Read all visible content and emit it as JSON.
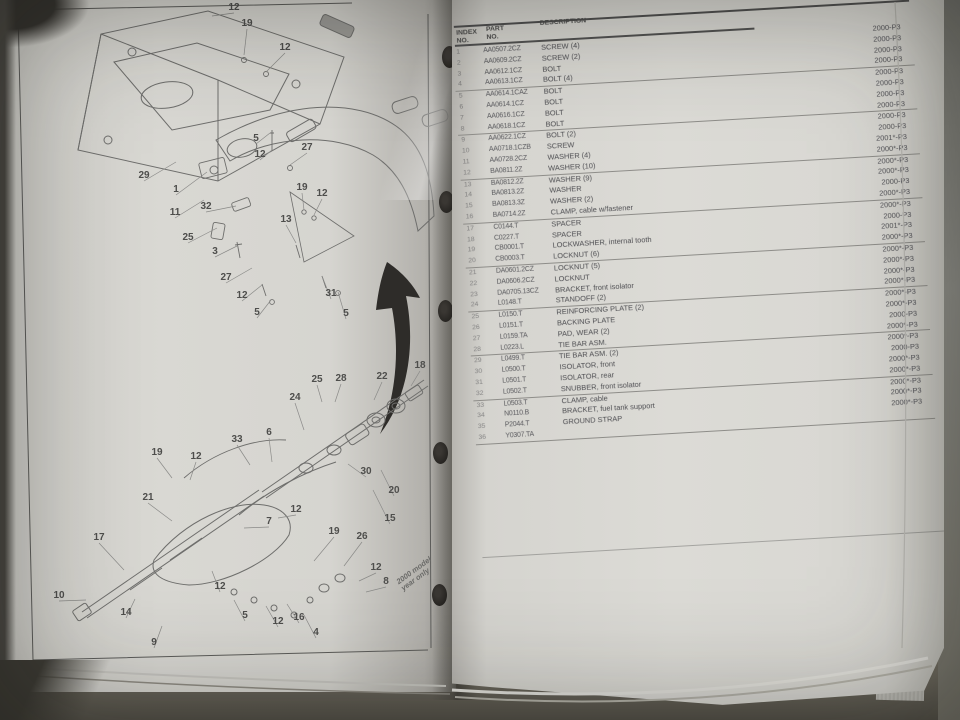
{
  "left_page": {
    "note_rotated": "2000 model\nyear only",
    "callouts": [
      {
        "n": "12",
        "x": 230,
        "y": 10,
        "lx": 208,
        "ly": 16
      },
      {
        "n": "19",
        "x": 243,
        "y": 26,
        "lx": 240,
        "ly": 55
      },
      {
        "n": "12",
        "x": 281,
        "y": 50,
        "lx": 262,
        "ly": 72
      },
      {
        "n": "5",
        "x": 252,
        "y": 141,
        "lx": 266,
        "ly": 133
      },
      {
        "n": "12",
        "x": 256,
        "y": 157,
        "lx": 268,
        "ly": 150
      },
      {
        "n": "27",
        "x": 303,
        "y": 150,
        "lx": 286,
        "ly": 165
      },
      {
        "n": "29",
        "x": 140,
        "y": 178,
        "lx": 172,
        "ly": 162
      },
      {
        "n": "1",
        "x": 172,
        "y": 192,
        "lx": 203,
        "ly": 172
      },
      {
        "n": "11",
        "x": 171,
        "y": 215,
        "lx": 200,
        "ly": 200
      },
      {
        "n": "32",
        "x": 202,
        "y": 209,
        "lx": 232,
        "ly": 206
      },
      {
        "n": "25",
        "x": 184,
        "y": 240,
        "lx": 213,
        "ly": 228
      },
      {
        "n": "3",
        "x": 211,
        "y": 254,
        "lx": 233,
        "ly": 246
      },
      {
        "n": "19",
        "x": 298,
        "y": 190,
        "lx": 300,
        "ly": 210
      },
      {
        "n": "12",
        "x": 318,
        "y": 196,
        "lx": 310,
        "ly": 215
      },
      {
        "n": "13",
        "x": 282,
        "y": 222,
        "lx": 292,
        "ly": 243
      },
      {
        "n": "27",
        "x": 222,
        "y": 280,
        "lx": 248,
        "ly": 268
      },
      {
        "n": "12",
        "x": 238,
        "y": 298,
        "lx": 258,
        "ly": 285
      },
      {
        "n": "5",
        "x": 253,
        "y": 315,
        "lx": 267,
        "ly": 300
      },
      {
        "n": "31",
        "x": 327,
        "y": 296,
        "lx": 318,
        "ly": 276
      },
      {
        "n": "5",
        "x": 342,
        "y": 316,
        "lx": 334,
        "ly": 292
      },
      {
        "n": "25",
        "x": 313,
        "y": 382,
        "lx": 318,
        "ly": 402
      },
      {
        "n": "28",
        "x": 337,
        "y": 381,
        "lx": 331,
        "ly": 402
      },
      {
        "n": "22",
        "x": 378,
        "y": 379,
        "lx": 370,
        "ly": 400
      },
      {
        "n": "18",
        "x": 416,
        "y": 368,
        "lx": 407,
        "ly": 386
      },
      {
        "n": "24",
        "x": 291,
        "y": 400,
        "lx": 300,
        "ly": 430
      },
      {
        "n": "33",
        "x": 233,
        "y": 442,
        "lx": 246,
        "ly": 465
      },
      {
        "n": "6",
        "x": 265,
        "y": 435,
        "lx": 268,
        "ly": 462
      },
      {
        "n": "19",
        "x": 153,
        "y": 455,
        "lx": 168,
        "ly": 478
      },
      {
        "n": "12",
        "x": 192,
        "y": 459,
        "lx": 186,
        "ly": 480
      },
      {
        "n": "30",
        "x": 362,
        "y": 474,
        "lx": 344,
        "ly": 464
      },
      {
        "n": "20",
        "x": 390,
        "y": 493,
        "lx": 377,
        "ly": 470
      },
      {
        "n": "15",
        "x": 386,
        "y": 521,
        "lx": 369,
        "ly": 490
      },
      {
        "n": "21",
        "x": 144,
        "y": 500,
        "lx": 168,
        "ly": 521
      },
      {
        "n": "12",
        "x": 292,
        "y": 512,
        "lx": 274,
        "ly": 518
      },
      {
        "n": "7",
        "x": 265,
        "y": 524,
        "lx": 240,
        "ly": 528
      },
      {
        "n": "17",
        "x": 95,
        "y": 540,
        "lx": 120,
        "ly": 570
      },
      {
        "n": "19",
        "x": 330,
        "y": 534,
        "lx": 310,
        "ly": 561
      },
      {
        "n": "26",
        "x": 358,
        "y": 539,
        "lx": 340,
        "ly": 566
      },
      {
        "n": "12",
        "x": 372,
        "y": 570,
        "lx": 355,
        "ly": 581
      },
      {
        "n": "8",
        "x": 382,
        "y": 584,
        "lx": 362,
        "ly": 592
      },
      {
        "n": "12",
        "x": 216,
        "y": 589,
        "lx": 208,
        "ly": 571
      },
      {
        "n": "5",
        "x": 241,
        "y": 618,
        "lx": 230,
        "ly": 600
      },
      {
        "n": "12",
        "x": 274,
        "y": 624,
        "lx": 262,
        "ly": 606
      },
      {
        "n": "16",
        "x": 295,
        "y": 620,
        "lx": 283,
        "ly": 604
      },
      {
        "n": "4",
        "x": 312,
        "y": 635,
        "lx": 300,
        "ly": 615
      },
      {
        "n": "10",
        "x": 55,
        "y": 598,
        "lx": 82,
        "ly": 600
      },
      {
        "n": "14",
        "x": 122,
        "y": 615,
        "lx": 131,
        "ly": 599
      },
      {
        "n": "9",
        "x": 150,
        "y": 645,
        "lx": 158,
        "ly": 626
      }
    ]
  },
  "right_page": {
    "header": {
      "col_index": "INDEX\nNO.",
      "col_part": "PART\nNO.",
      "col_desc": "DESCRIPTION"
    },
    "cutoff_years": [
      "2000*-P3",
      "2000*-P3"
    ],
    "rows": [
      {
        "index": "1",
        "part": "AA0507.2CZ",
        "desc": "SCREW (4)",
        "year": "2000-P3"
      },
      {
        "index": "2",
        "part": "AA0609.2CZ",
        "desc": "SCREW (2)",
        "year": "2000-P3"
      },
      {
        "index": "3",
        "part": "AA0612.1CZ",
        "desc": "BOLT",
        "year": "2000-P3"
      },
      {
        "index": "4",
        "part": "AA0613.1CZ",
        "desc": "BOLT (4)",
        "year": "2000-P3"
      },
      {
        "index": "5",
        "part": "AA0614.1CAZ",
        "desc": "BOLT",
        "year": "2000-P3"
      },
      {
        "index": "6",
        "part": "AA0614.1CZ",
        "desc": "BOLT",
        "year": "2000-P3"
      },
      {
        "index": "7",
        "part": "AA0616.1CZ",
        "desc": "BOLT",
        "year": "2000-P3"
      },
      {
        "index": "8",
        "part": "AA0618.1CZ",
        "desc": "BOLT",
        "year": "2000-P3"
      },
      {
        "index": "9",
        "part": "AA0622.1CZ",
        "desc": "BOLT (2)",
        "year": "2000-P3"
      },
      {
        "index": "10",
        "part": "AA0718.1CZB",
        "desc": "SCREW",
        "year": "2000-P3"
      },
      {
        "index": "11",
        "part": "AA0728.2CZ",
        "desc": "WASHER (4)",
        "year": "2001*-P3"
      },
      {
        "index": "12",
        "part": "BA0811.2Z",
        "desc": "WASHER (10)",
        "year": "2000*-P3"
      },
      {
        "index": "13",
        "part": "BA0812.2Z",
        "desc": "WASHER (9)",
        "year": "2000*-P3"
      },
      {
        "index": "14",
        "part": "BA0813.2Z",
        "desc": "WASHER",
        "year": "2000*-P3"
      },
      {
        "index": "15",
        "part": "BA0813.3Z",
        "desc": "WASHER (2)",
        "year": "2000-P3"
      },
      {
        "index": "16",
        "part": "BA0714.2Z",
        "desc": "CLAMP, cable w/fastener",
        "year": "2000*-P3"
      },
      {
        "index": "17",
        "part": "C0144.T",
        "desc": "SPACER",
        "year": "2000*-P3"
      },
      {
        "index": "18",
        "part": "C0227.T",
        "desc": "SPACER",
        "year": "2000-P3"
      },
      {
        "index": "19",
        "part": "CB0001.T",
        "desc": "LOCKWASHER, internal tooth",
        "year": "2001*-P3"
      },
      {
        "index": "20",
        "part": "CB0003.T",
        "desc": "LOCKNUT (6)",
        "year": "2000*-P3"
      },
      {
        "index": "21",
        "part": "DA0601.2CZ",
        "desc": "LOCKNUT (5)",
        "year": "2000*-P3"
      },
      {
        "index": "22",
        "part": "DA0606.2CZ",
        "desc": "LOCKNUT",
        "year": "2000*-P3"
      },
      {
        "index": "23",
        "part": "DA0705.13CZ",
        "desc": "BRACKET, front isolator",
        "year": "2000*-P3"
      },
      {
        "index": "24",
        "part": "L0148.T",
        "desc": "STANDOFF (2)",
        "year": "2000*-P3"
      },
      {
        "index": "25",
        "part": "L0150.T",
        "desc": "REINFORCING PLATE (2)",
        "year": "2000*-P3"
      },
      {
        "index": "26",
        "part": "L0151.T",
        "desc": "BACKING PLATE",
        "year": "2000*-P3"
      },
      {
        "index": "27",
        "part": "L0159.TA",
        "desc": "PAD, WEAR (2)",
        "year": "2000-P3"
      },
      {
        "index": "28",
        "part": "L0223.L",
        "desc": "TIE BAR ASM.",
        "year": "2000*-P3"
      },
      {
        "index": "29",
        "part": "L0499.T",
        "desc": "TIE BAR ASM. (2)",
        "year": "2000*-P3"
      },
      {
        "index": "30",
        "part": "L0500.T",
        "desc": "ISOLATOR, front",
        "year": "2000-P3"
      },
      {
        "index": "31",
        "part": "L0501.T",
        "desc": "ISOLATOR, rear",
        "year": "2000*-P3"
      },
      {
        "index": "32",
        "part": "L0502.T",
        "desc": "SNUBBER, front isolator",
        "year": "2000*-P3"
      },
      {
        "index": "33",
        "part": "L0503.T",
        "desc": "CLAMP, cable",
        "year": "2000*-P3"
      },
      {
        "index": "34",
        "part": "N0110.B",
        "desc": "BRACKET, fuel tank support",
        "year": "2000*-P3"
      },
      {
        "index": "35",
        "part": "P2044.T",
        "desc": "GROUND STRAP",
        "year": "2000*-P3"
      },
      {
        "index": "36",
        "part": "Y0307.TA",
        "desc": "",
        "year": ""
      }
    ]
  }
}
